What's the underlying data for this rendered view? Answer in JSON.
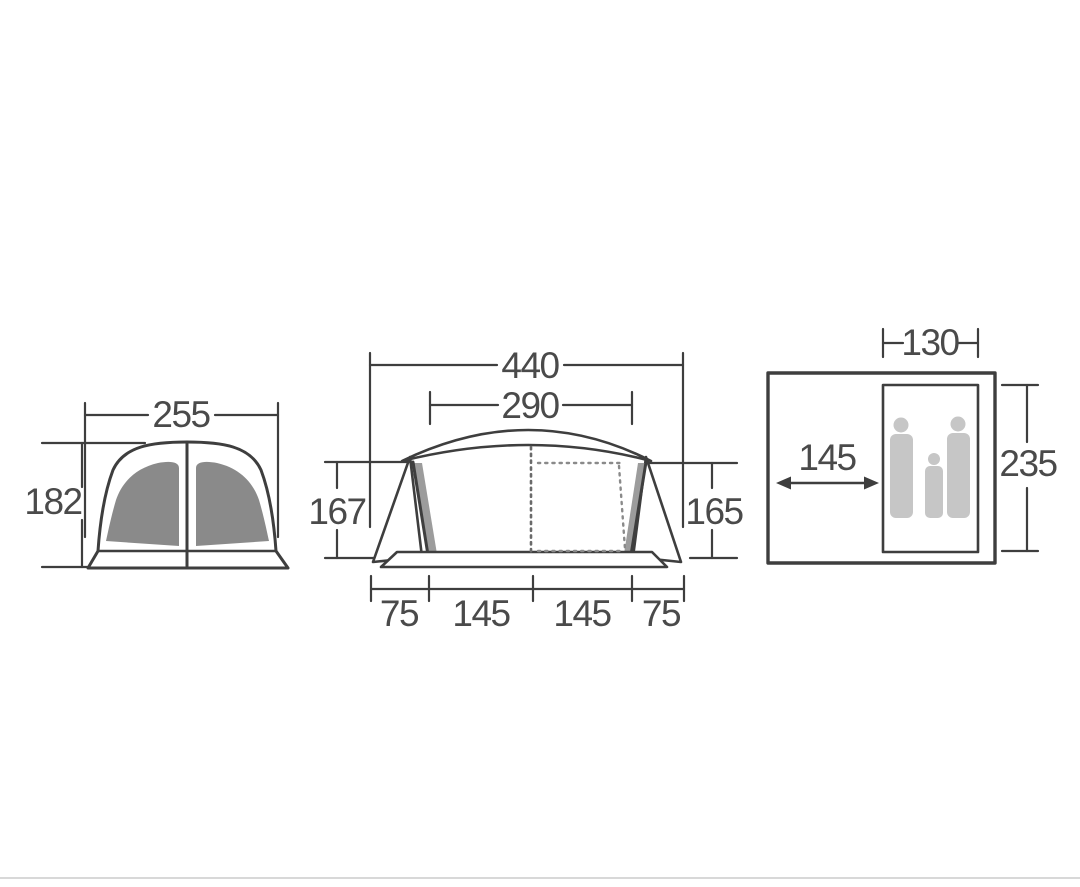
{
  "diagram": {
    "title": "tent dimensions drawing",
    "front_view": {
      "width": "255",
      "height": "182"
    },
    "side_view": {
      "overall_width": "440",
      "inner_width": "290",
      "left_height": "167",
      "right_height": "165",
      "base_segments": [
        "75",
        "145",
        "145",
        "75"
      ]
    },
    "floor_plan": {
      "bedroom_width": "130",
      "living_depth": "145",
      "bedroom_depth": "235"
    }
  },
  "colors": {
    "line": "#3e3e3e",
    "label_text": "#4a4a4a",
    "door_panel_gray": "#8a8a8a",
    "wall_shading_gray": "#9c9c9c",
    "silhouette_gray": "#c6c6c6",
    "background": "#ffffff",
    "bottom_rule": "#d8d8d8"
  }
}
